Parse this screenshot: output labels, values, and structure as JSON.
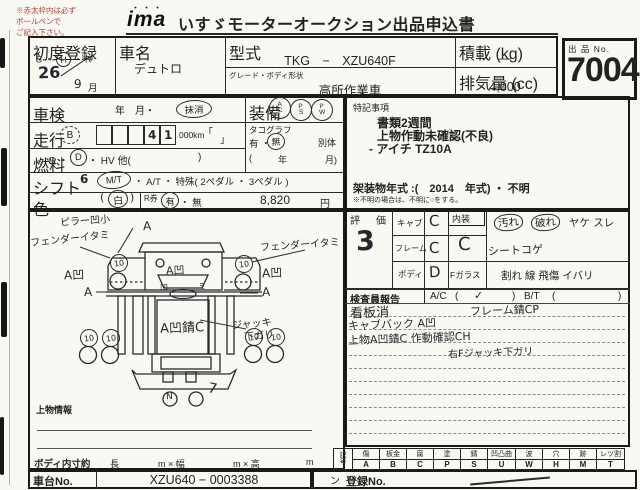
{
  "note": {
    "lines": [
      "※赤太枠内は必ず",
      "ボールペンで",
      "ご記入下さい。"
    ]
  },
  "header": {
    "logo": "ima",
    "logo_dots": "・・・",
    "title": "いすゞモーターオークション出品申込書"
  },
  "lot": {
    "label": "出 品 No.",
    "number": "7004"
  },
  "first_reg": {
    "label": "初度登録",
    "era": "S ・ H ・ R",
    "era_circled": "H",
    "sep1": "S ・",
    "sep2": "・ R",
    "year": "26",
    "month": "9",
    "month_label": "月"
  },
  "car": {
    "label": "車名",
    "value": "デュトロ"
  },
  "model": {
    "label": "型式",
    "value": "TKG　−　XZU640F"
  },
  "grade": {
    "label": "グレード・ボディ形状",
    "value": "高所作業車"
  },
  "payload": {
    "label": "積載 (kg)",
    "value": "—"
  },
  "displacement": {
    "label": "排気量 (cc)",
    "value": "4,000"
  },
  "inspection": {
    "label": "車検",
    "text": "年　月・",
    "cancelled": "抹消"
  },
  "equipment": {
    "label": "装備",
    "items": [
      {
        "top": "A",
        "bottom": "C"
      },
      {
        "top": "P",
        "bottom": "S"
      },
      {
        "top": "P",
        "bottom": "W"
      }
    ]
  },
  "mileage": {
    "label": "走行",
    "grade": "B",
    "digits": [
      "",
      "",
      "",
      "4",
      "1"
    ],
    "unit": "000km",
    "bracket_open": "「",
    "bracket_close": "」"
  },
  "tachograph": {
    "label": "タコグラフ",
    "present": "有 ・",
    "absent": "無",
    "separate": "別体",
    "paren_open": "(",
    "year": "年",
    "month": "月)"
  },
  "fuel": {
    "label": "燃料",
    "g": "G ・",
    "d": "D",
    "rest": "・ HV 他(",
    "close": ")"
  },
  "shift": {
    "label": "シフト",
    "hand": "6",
    "mt": "M/T",
    "rest": "・ A/T ・ 特殊( 2ペダル ・ 3ペダル )"
  },
  "color": {
    "label": "色",
    "open": "(",
    "value": "白",
    "close": ")"
  },
  "r_ticket": {
    "label": "R券",
    "yes": "有",
    "no": "・ 無",
    "price": "8,820",
    "unit": "円"
  },
  "remarks": {
    "label": "特記事項",
    "lines": [
      "書類2週間",
      "上物作動未確認(不良)",
      "- アイチ TZ10A"
    ],
    "body_year": "架装物年式 :(　2014　年式) ・ 不明",
    "note": "※不明の場合は、不明に○をする。"
  },
  "evaluation": {
    "label": "評　価",
    "score": "3",
    "rows": [
      {
        "label": "キャブ",
        "value": "C"
      },
      {
        "label": "フレーム",
        "value": "C"
      },
      {
        "label": "ボディ",
        "value": "D"
      }
    ],
    "interior_label": "内装",
    "interior_value": "C",
    "interior_opt1": "汚れ",
    "interior_opt2": "破れ",
    "interior_opt3": "ヤケ スレ",
    "interior_note": "シートコゲ",
    "fglass_label": "Fガラス",
    "fglass_options": "割れ 線 飛傷 イバリ"
  },
  "inspector": {
    "label": "検査員報告",
    "ac_label": "A/C",
    "bt_label": "B/T",
    "paren_open": "(",
    "paren_close": ")",
    "check": "✓",
    "notes": [
      {
        "text": "看板消"
      },
      {
        "text": "フレーム錆CP"
      },
      {
        "text": "キャブバック A凹"
      },
      {
        "text": "上物A凹錆C 作動確認CH"
      },
      {
        "text": "右Fジャッキ下ガリ"
      }
    ]
  },
  "diagram": {
    "pillar": "ピラー凹小",
    "fender_left": "フェンダーイタミ",
    "fender_right": "フェンダーイタミ",
    "a_top": "A",
    "dent_left": "A凹",
    "dent_right": "A凹",
    "a_left": "A",
    "a_right": "A",
    "cab_dent": "A凹",
    "cab_small_left": "凹",
    "cab_small_right": "ミ",
    "center": "A凹錆C",
    "jack_line1": "ジャッキ",
    "jack_line2": "下ガリ",
    "rear_mark": "N",
    "rear_stroke": "7",
    "wheel": "10"
  },
  "cargo_info": {
    "label": "上物情報"
  },
  "dimensions": {
    "label": "ボディ内寸約",
    "d1": "長",
    "d2": "m × 幅",
    "d3": "m × 高",
    "d4": "m"
  },
  "chassis": {
    "label": "車台No.",
    "value": "XZU640 − 0003388"
  },
  "registration": {
    "label": "登録No.",
    "tick": "ン"
  },
  "legend": {
    "symbol1": "記",
    "symbol2": "号",
    "cols": [
      {
        "h": "傷",
        "v": "A"
      },
      {
        "h": "板金",
        "v": "B"
      },
      {
        "h": "腐",
        "v": "C"
      },
      {
        "h": "塗",
        "v": "P"
      },
      {
        "h": "錆",
        "v": "S"
      },
      {
        "h": "凹凸曲",
        "v": "U"
      },
      {
        "h": "波",
        "v": "W"
      },
      {
        "h": "穴",
        "v": "H"
      },
      {
        "h": "跡",
        "v": "M"
      },
      {
        "h": "レツ割",
        "v": "T"
      }
    ]
  }
}
